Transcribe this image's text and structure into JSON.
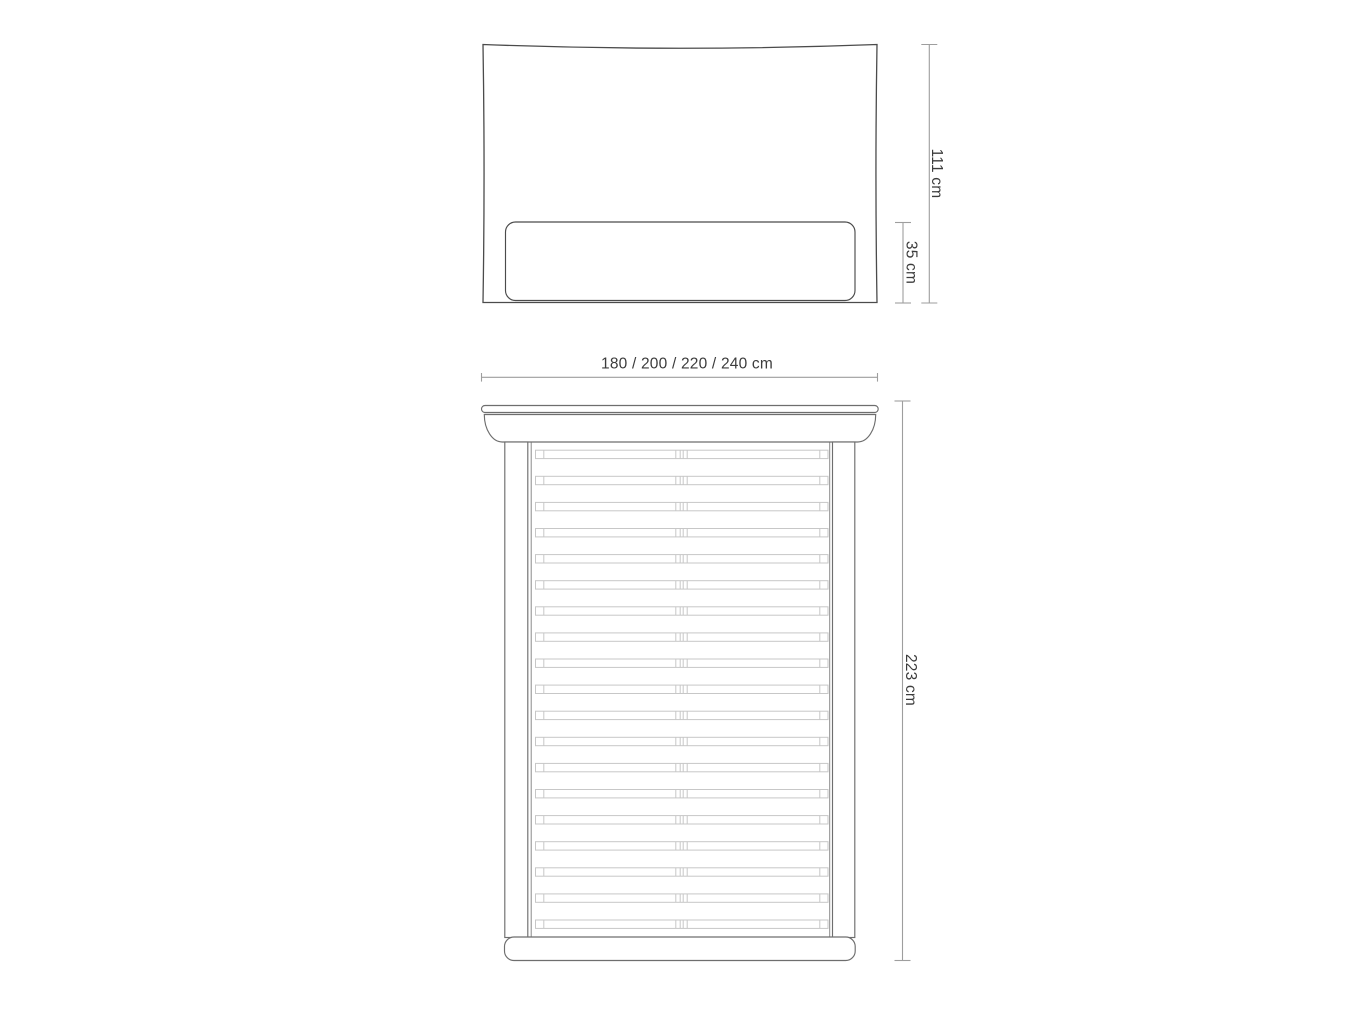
{
  "diagram": {
    "front_view": {
      "height_total_label": "111 cm",
      "height_lower_label": "35 cm"
    },
    "top_view": {
      "width_label": "180 / 200 / 220 / 240 cm",
      "length_label": "223 cm",
      "slat_count": 19,
      "slat_pitch_px": 26.1
    },
    "colors": {
      "outline_dark": "#4b4b4b",
      "outline_medium": "#6e6e6e",
      "slat": "#c7c7c7",
      "dimension": "#9e9e9e",
      "label_text": "#3c3c3c",
      "background": "#ffffff"
    }
  }
}
